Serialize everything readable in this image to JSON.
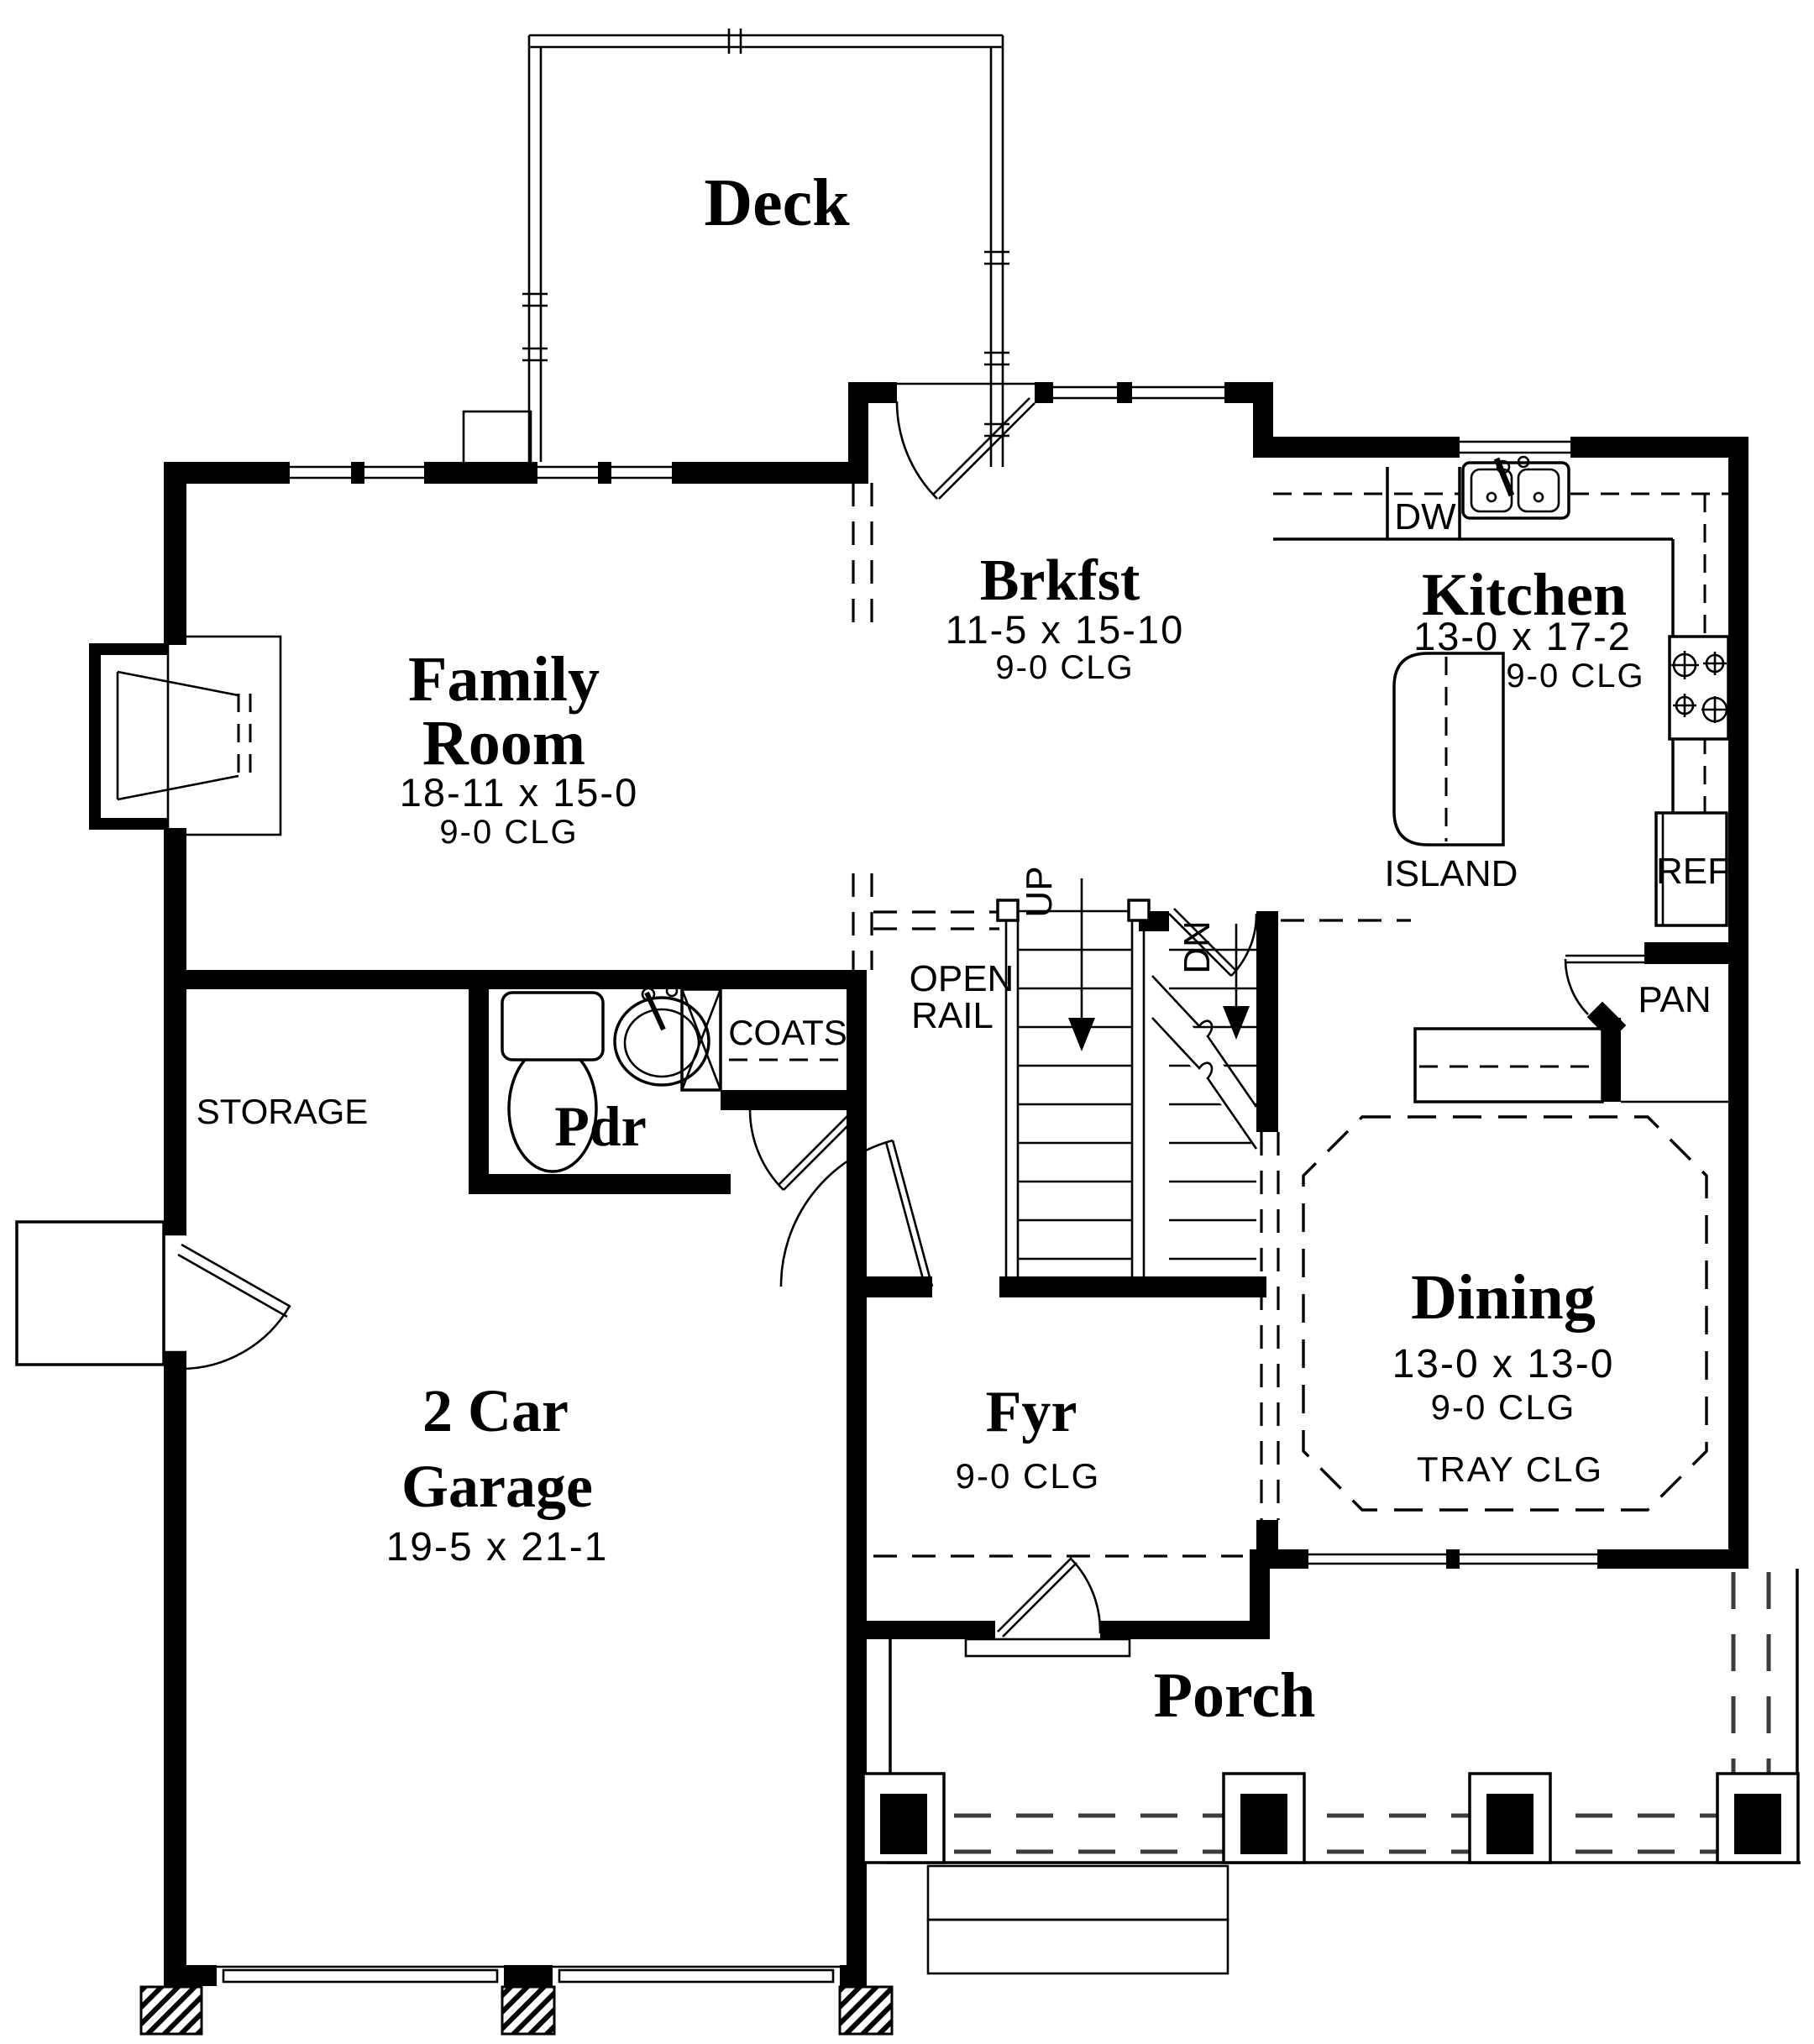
{
  "rooms": {
    "deck": {
      "name": "Deck"
    },
    "family_room": {
      "name_line1": "Family",
      "name_line2": "Room",
      "dims": "18-11 x 15-0",
      "ceiling": "9-0 CLG"
    },
    "breakfast": {
      "name": "Brkfst",
      "dims": "11-5 x 15-10",
      "ceiling": "9-0 CLG"
    },
    "kitchen": {
      "name": "Kitchen",
      "dims": "13-0 x 17-2",
      "ceiling": "9-0 CLG"
    },
    "dining": {
      "name": "Dining",
      "dims": "13-0 x 13-0",
      "ceiling": "9-0 CLG",
      "ceiling_note": "TRAY CLG"
    },
    "foyer": {
      "name": "Fyr",
      "ceiling": "9-0 CLG"
    },
    "powder_room": {
      "name": "Pdr"
    },
    "storage": {
      "name": "STORAGE"
    },
    "coats_closet": {
      "name": "COATS"
    },
    "garage": {
      "name_line1": "2 Car",
      "name_line2": "Garage",
      "dims": "19-5 x 21-1"
    },
    "porch": {
      "name": "Porch"
    }
  },
  "kitchen_fixtures": {
    "dishwasher": "DW",
    "refrigerator": "REF",
    "pantry": "PAN",
    "island": "ISLAND"
  },
  "stairs": {
    "up_label": "UP",
    "down_label": "DN",
    "open_rail_line1": "OPEN",
    "open_rail_line2": "RAIL"
  },
  "colors": {
    "ink": "#000000",
    "paper": "#ffffff"
  }
}
